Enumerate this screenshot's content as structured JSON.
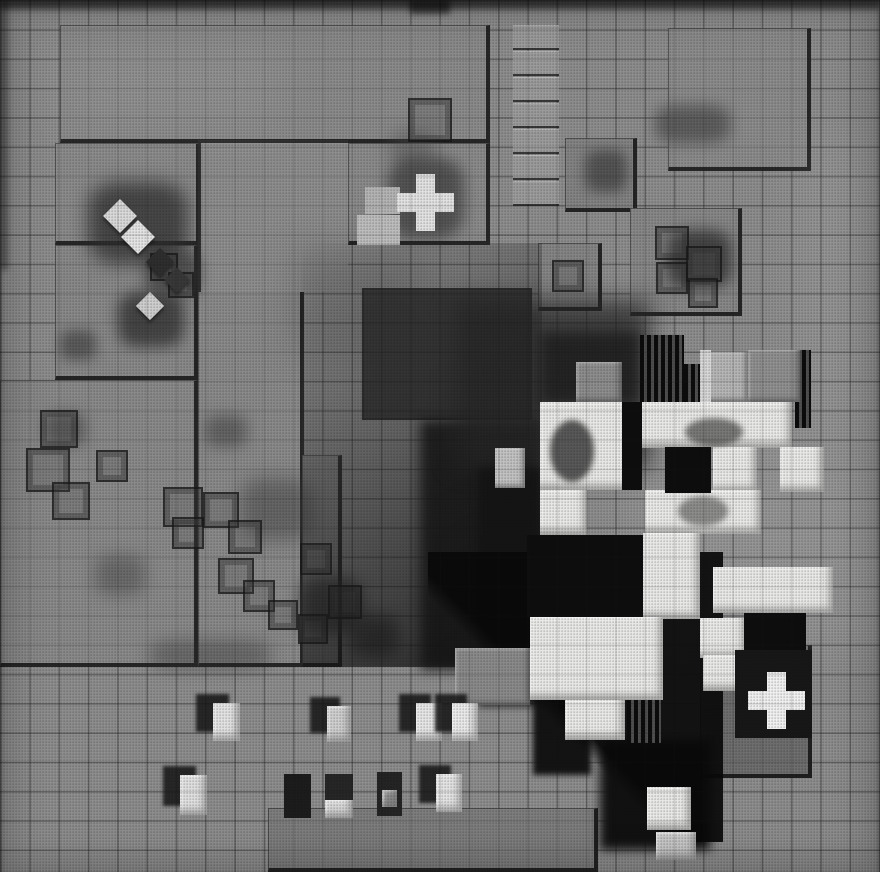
{
  "meta": {
    "alt": "Black-and-white halftone photograph, overhead view of a LEGO architectural model: studded baseplates on a tiled grid, a central cluster of white block towers casting hard black shadows, two white cross-shaped tiles, small white blocks and dark stains",
    "description": "Overhead black-and-white photo of a LEGO site model. Gray tiled ground with studded baseplates, phantom brick outlines and soot stains, a pinwheel cluster of white towers with deep shadows at right-center, a white cross tile on the upper plate and another on a dark plate at lower right, and rows of small white blocks near the bottom."
  },
  "palette": {
    "base": "#8e8e8e",
    "plate": "#8b8b8b",
    "plate_dark": "#6e6e6e",
    "white": "#e9e9e7",
    "void_black": "#0d0d0d",
    "shadow": "#141414",
    "stain": "#303030"
  },
  "canvas": {
    "width": 880,
    "height": 872,
    "tile_px": 29.3
  },
  "scene": {
    "plates": [
      {
        "x": 60,
        "y": 25,
        "w": 430,
        "h": 118,
        "tone": "#8b8b8b"
      },
      {
        "x": 348,
        "y": 143,
        "w": 142,
        "h": 102,
        "tone": "#8b8b8b"
      },
      {
        "x": 55,
        "y": 143,
        "w": 145,
        "h": 102,
        "tone": "#8b8b8b"
      },
      {
        "x": 55,
        "y": 245,
        "w": 143,
        "h": 135,
        "tone": "#898989"
      },
      {
        "x": 0,
        "y": 380,
        "w": 198,
        "h": 287,
        "tone": "#8a8a8a"
      },
      {
        "x": 198,
        "y": 290,
        "w": 106,
        "h": 377,
        "tone": "#8a8a8a"
      },
      {
        "x": 302,
        "y": 455,
        "w": 40,
        "h": 212,
        "tone": "#868686"
      },
      {
        "x": 565,
        "y": 138,
        "w": 72,
        "h": 74,
        "tone": "#848484"
      },
      {
        "x": 668,
        "y": 28,
        "w": 143,
        "h": 143,
        "tone": "#8c8c8c"
      },
      {
        "x": 630,
        "y": 208,
        "w": 112,
        "h": 108,
        "tone": "#888888"
      },
      {
        "x": 538,
        "y": 243,
        "w": 64,
        "h": 68,
        "tone": "#858585"
      },
      {
        "x": 268,
        "y": 808,
        "w": 330,
        "h": 64,
        "tone": "#7e7e7e"
      },
      {
        "x": 700,
        "y": 645,
        "w": 112,
        "h": 133,
        "tone": "#6e6e6e"
      }
    ],
    "plain_patches": [
      {
        "x": 198,
        "y": 140,
        "w": 150,
        "h": 152
      }
    ],
    "ladder": {
      "x": 513,
      "y": 25,
      "w": 46,
      "rungs": 7,
      "rung_h": 23,
      "gap": 3,
      "tone": "#9c9c9c"
    },
    "mottle": [
      {
        "x": 640,
        "y": 430,
        "w": 240,
        "h": 210,
        "c": "#ffffff",
        "o": 0.07,
        "blur": 28
      },
      {
        "x": 800,
        "y": 140,
        "w": 80,
        "h": 280,
        "c": "#ffffff",
        "o": 0.06,
        "blur": 24
      },
      {
        "x": 60,
        "y": 40,
        "w": 220,
        "h": 90,
        "c": "#ffffff",
        "o": 0.05,
        "blur": 24
      },
      {
        "x": 290,
        "y": 245,
        "w": 130,
        "h": 110,
        "c": "#000000",
        "o": 0.12,
        "blur": 20
      },
      {
        "x": 0,
        "y": 0,
        "w": 880,
        "h": 10,
        "c": "#000000",
        "o": 0.45,
        "blur": 3
      },
      {
        "x": 0,
        "y": 0,
        "w": 8,
        "h": 270,
        "c": "#000000",
        "o": 0.35,
        "blur": 3
      },
      {
        "x": 410,
        "y": 0,
        "w": 40,
        "h": 14,
        "c": "#000000",
        "o": 0.5,
        "blur": 3
      }
    ],
    "smudges": [
      {
        "x": 88,
        "y": 182,
        "w": 100,
        "h": 82,
        "c": "#2f2f2f",
        "o": 0.75,
        "blur": 9
      },
      {
        "x": 118,
        "y": 292,
        "w": 66,
        "h": 55,
        "c": "#343434",
        "o": 0.8,
        "blur": 7
      },
      {
        "x": 60,
        "y": 330,
        "w": 36,
        "h": 30,
        "c": "#3a3a3a",
        "o": 0.6,
        "blur": 6
      },
      {
        "x": 145,
        "y": 250,
        "w": 55,
        "h": 45,
        "c": "#303030",
        "o": 0.6,
        "blur": 7
      },
      {
        "x": 585,
        "y": 150,
        "w": 42,
        "h": 42,
        "c": "#3f3f3f",
        "o": 0.7,
        "blur": 6
      },
      {
        "x": 655,
        "y": 105,
        "w": 75,
        "h": 38,
        "c": "#4a4a4a",
        "o": 0.7,
        "blur": 7
      },
      {
        "x": 668,
        "y": 230,
        "w": 64,
        "h": 58,
        "c": "#2c2c2c",
        "o": 0.75,
        "blur": 7
      },
      {
        "x": 390,
        "y": 130,
        "w": 45,
        "h": 35,
        "c": "#4a4a4a",
        "o": 0.4,
        "blur": 8
      },
      {
        "x": 300,
        "y": 578,
        "w": 62,
        "h": 56,
        "c": "#2e2e2e",
        "o": 0.7,
        "blur": 8
      },
      {
        "x": 350,
        "y": 615,
        "w": 48,
        "h": 42,
        "c": "#343434",
        "o": 0.7,
        "blur": 8
      },
      {
        "x": 240,
        "y": 478,
        "w": 72,
        "h": 62,
        "c": "#3a3a3a",
        "o": 0.45,
        "blur": 9
      },
      {
        "x": 45,
        "y": 412,
        "w": 40,
        "h": 34,
        "c": "#333333",
        "o": 0.5,
        "blur": 7
      },
      {
        "x": 205,
        "y": 415,
        "w": 42,
        "h": 32,
        "c": "#3c3c3c",
        "o": 0.5,
        "blur": 7
      },
      {
        "x": 95,
        "y": 555,
        "w": 50,
        "h": 40,
        "c": "#3a3a3a",
        "o": 0.4,
        "blur": 8
      },
      {
        "x": 150,
        "y": 640,
        "w": 120,
        "h": 30,
        "c": "#2a2a2a",
        "o": 0.35,
        "blur": 8
      },
      {
        "x": 388,
        "y": 158,
        "w": 76,
        "h": 80,
        "c": "#262626",
        "o": 0.55,
        "blur": 7
      }
    ],
    "phantom_bricks": [
      {
        "x": 408,
        "y": 98,
        "s": 44
      },
      {
        "x": 40,
        "y": 410,
        "s": 38
      },
      {
        "x": 26,
        "y": 448,
        "s": 44
      },
      {
        "x": 52,
        "y": 482,
        "s": 38
      },
      {
        "x": 96,
        "y": 450,
        "s": 32
      },
      {
        "x": 150,
        "y": 253,
        "s": 28
      },
      {
        "x": 168,
        "y": 272,
        "s": 26
      },
      {
        "x": 163,
        "y": 487,
        "s": 40
      },
      {
        "x": 203,
        "y": 492,
        "s": 36
      },
      {
        "x": 172,
        "y": 517,
        "s": 32
      },
      {
        "x": 228,
        "y": 520,
        "s": 34
      },
      {
        "x": 218,
        "y": 558,
        "s": 36
      },
      {
        "x": 243,
        "y": 580,
        "s": 32
      },
      {
        "x": 268,
        "y": 600,
        "s": 30
      },
      {
        "x": 300,
        "y": 543,
        "s": 32
      },
      {
        "x": 328,
        "y": 585,
        "s": 34
      },
      {
        "x": 298,
        "y": 614,
        "s": 30
      },
      {
        "x": 655,
        "y": 226,
        "s": 34
      },
      {
        "x": 686,
        "y": 246,
        "s": 36
      },
      {
        "x": 656,
        "y": 262,
        "s": 32
      },
      {
        "x": 688,
        "y": 278,
        "s": 30
      },
      {
        "x": 552,
        "y": 260,
        "s": 32
      }
    ],
    "tilted_tiles": [
      {
        "x": 108,
        "y": 204,
        "s": 24,
        "tone": "#dadada"
      },
      {
        "x": 126,
        "y": 225,
        "s": 24,
        "tone": "#e4e4e4"
      },
      {
        "x": 140,
        "y": 296,
        "s": 20,
        "tone": "#cfcfcf"
      },
      {
        "x": 150,
        "y": 252,
        "s": 20,
        "tone": "#2e2e2e"
      },
      {
        "x": 168,
        "y": 271,
        "s": 18,
        "tone": "#383838"
      }
    ],
    "light_tiles": [
      {
        "x": 365,
        "y": 187,
        "w": 35,
        "h": 27,
        "tone": "#b4b4b4"
      },
      {
        "x": 357,
        "y": 215,
        "w": 43,
        "h": 30,
        "tone": "#bdbdbd"
      }
    ],
    "shade": {
      "gradient_region": {
        "x": 302,
        "y": 243,
        "w": 240,
        "h": 424
      },
      "dark_square": {
        "x": 362,
        "y": 288,
        "w": 170,
        "h": 132,
        "c": "#262626",
        "o": 0.8
      },
      "dark_mass": {
        "x": 420,
        "y": 420,
        "w": 122,
        "h": 250,
        "c": "#141414",
        "o": 0.85,
        "blur": 6
      },
      "faint_studs": {
        "x": 340,
        "y": 243,
        "w": 200,
        "h": 64,
        "o": 0.3
      }
    },
    "cluster": {
      "shadow_boxes": [
        {
          "x": 455,
          "y": 300,
          "w": 195,
          "h": 168,
          "c": "#262626",
          "o": 0.75,
          "blur": 12
        },
        {
          "x": 478,
          "y": 468,
          "w": 64,
          "h": 238,
          "c": "#141414",
          "o": 0.9,
          "blur": 4
        },
        {
          "x": 533,
          "y": 635,
          "w": 58,
          "h": 140,
          "c": "#0d0d0d",
          "o": 0.95,
          "blur": 3
        },
        {
          "x": 600,
          "y": 740,
          "w": 110,
          "h": 110,
          "c": "#0b0b0b",
          "o": 0.95,
          "blur": 5
        },
        {
          "x": 540,
          "y": 332,
          "w": 100,
          "h": 72,
          "c": "#1f1f1f",
          "o": 0.85,
          "blur": 6
        }
      ],
      "diag_shadow": {
        "x": 428,
        "y": 552,
        "w": 295,
        "h": 290
      },
      "facades": [
        {
          "x": 640,
          "y": 335,
          "w": 44,
          "h": 68
        },
        {
          "x": 684,
          "y": 364,
          "w": 18,
          "h": 40
        },
        {
          "x": 795,
          "y": 350,
          "w": 16,
          "h": 78
        },
        {
          "x": 627,
          "y": 657,
          "w": 34,
          "h": 86
        }
      ],
      "gray_blocks": [
        {
          "x": 576,
          "y": 362,
          "w": 46,
          "h": 40,
          "tone": "#8d8d8d"
        },
        {
          "x": 700,
          "y": 352,
          "w": 48,
          "h": 50,
          "tone": "#b6b6b6"
        },
        {
          "x": 748,
          "y": 350,
          "w": 52,
          "h": 52,
          "tone": "#909090"
        },
        {
          "x": 455,
          "y": 648,
          "w": 75,
          "h": 57,
          "tone": "#8a8a8a"
        },
        {
          "x": 495,
          "y": 448,
          "w": 30,
          "h": 40,
          "tone": "#c2c2c2"
        }
      ],
      "white_blocks": [
        {
          "x": 540,
          "y": 402,
          "w": 100,
          "h": 88
        },
        {
          "x": 640,
          "y": 402,
          "w": 152,
          "h": 46
        },
        {
          "x": 713,
          "y": 447,
          "w": 44,
          "h": 45
        },
        {
          "x": 780,
          "y": 447,
          "w": 44,
          "h": 45
        },
        {
          "x": 540,
          "y": 490,
          "w": 47,
          "h": 45
        },
        {
          "x": 645,
          "y": 490,
          "w": 116,
          "h": 44
        },
        {
          "x": 643,
          "y": 533,
          "w": 57,
          "h": 86
        },
        {
          "x": 713,
          "y": 567,
          "w": 120,
          "h": 46
        },
        {
          "x": 530,
          "y": 617,
          "w": 133,
          "h": 83
        },
        {
          "x": 565,
          "y": 700,
          "w": 60,
          "h": 40
        },
        {
          "x": 700,
          "y": 618,
          "w": 46,
          "h": 40
        },
        {
          "x": 703,
          "y": 655,
          "w": 45,
          "h": 36
        },
        {
          "x": 647,
          "y": 787,
          "w": 44,
          "h": 43
        },
        {
          "x": 656,
          "y": 832,
          "w": 40,
          "h": 28,
          "tone": "#c9c9c9"
        }
      ],
      "voids": [
        {
          "x": 622,
          "y": 402,
          "w": 20,
          "h": 88
        },
        {
          "x": 665,
          "y": 447,
          "w": 46,
          "h": 46
        },
        {
          "x": 527,
          "y": 535,
          "w": 116,
          "h": 82
        },
        {
          "x": 744,
          "y": 613,
          "w": 62,
          "h": 38
        }
      ],
      "roof_shadows": [
        {
          "x": 550,
          "y": 420,
          "w": 44,
          "h": 62,
          "o": 0.7
        },
        {
          "x": 685,
          "y": 418,
          "w": 58,
          "h": 28,
          "o": 0.55
        },
        {
          "x": 678,
          "y": 496,
          "w": 50,
          "h": 30,
          "o": 0.45
        }
      ],
      "slivers": [
        {
          "x": 700,
          "y": 350,
          "w": 11,
          "h": 52,
          "tone": "#d8d8d8"
        }
      ],
      "cross_backdrop": {
        "x": 735,
        "y": 650,
        "w": 77,
        "h": 88,
        "c": "#171717"
      }
    },
    "crosses": [
      {
        "cx": 425,
        "cy": 202,
        "cell": 19,
        "tone": "#e2e2e2"
      },
      {
        "cx": 776,
        "cy": 700,
        "cell": 19,
        "tone": "#f0f0f0"
      }
    ],
    "small_block_shadow": {
      "dx": -17,
      "dy": -9,
      "c": "rgba(20,20,20,0.85)",
      "blur": 1.5
    },
    "small_blocks": [
      {
        "x": 213,
        "y": 703,
        "w": 27,
        "h": 38,
        "tone": "#e3e3e3",
        "sh": true
      },
      {
        "x": 327,
        "y": 706,
        "w": 24,
        "h": 36,
        "tone": "#cfcfcf",
        "sh": true
      },
      {
        "x": 416,
        "y": 703,
        "w": 26,
        "h": 38,
        "tone": "#e6e6e6",
        "sh": true
      },
      {
        "x": 452,
        "y": 703,
        "w": 26,
        "h": 38,
        "tone": "#eaeaea",
        "sh": true
      },
      {
        "x": 180,
        "y": 775,
        "w": 27,
        "h": 40,
        "tone": "#e0e0e0",
        "sh": true
      },
      {
        "x": 284,
        "y": 774,
        "w": 27,
        "h": 44,
        "tone": "#1c1c1c",
        "sh": false
      },
      {
        "x": 325,
        "y": 774,
        "w": 28,
        "h": 28,
        "tone": "#262626",
        "sh": false
      },
      {
        "x": 325,
        "y": 800,
        "w": 28,
        "h": 18,
        "tone": "#d9d9d9",
        "sh": false
      },
      {
        "x": 377,
        "y": 772,
        "w": 25,
        "h": 44,
        "tone": "#242424",
        "sh": false
      },
      {
        "x": 382,
        "y": 790,
        "w": 15,
        "h": 17,
        "tone": "#8f8f8f",
        "sh": false
      },
      {
        "x": 436,
        "y": 774,
        "w": 26,
        "h": 38,
        "tone": "#e4e4e4",
        "sh": true
      }
    ]
  }
}
